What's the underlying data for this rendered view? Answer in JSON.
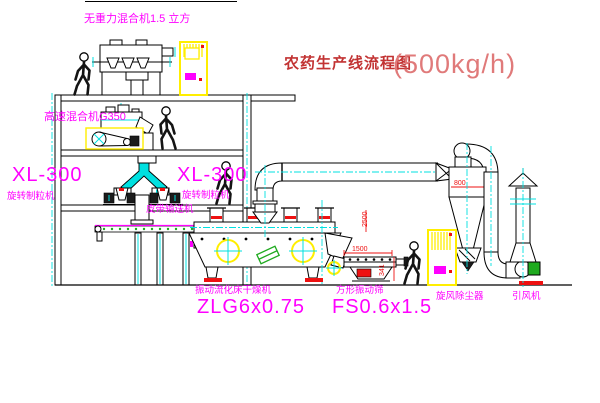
{
  "diagram": {
    "title": "农药生产线流程图",
    "capacity": "(500kg/h)"
  },
  "labels": {
    "gravity_mixer": "无重力混合机1.5 立方",
    "high_speed_mixer": "高速混合机G350",
    "granulator_left_model": "XL-300",
    "granulator_left_name": "旋转制粒机",
    "granulator_right_model": "XL-300",
    "granulator_right_name": "旋转制粒机",
    "belt_conveyor": "皮带输送机",
    "fluid_bed_name": "振动流化床干燥机",
    "fluid_bed_model": "ZLG6x0.75",
    "sieve_name": "方形振动筛",
    "sieve_model": "FS0.6x1.5",
    "cyclone": "旋风除尘器",
    "fan": "引风机"
  },
  "dimensions": {
    "cyclone_width": "800",
    "bed_outlet_height": "2500",
    "sieve_length": "1500",
    "sieve_height": "341"
  },
  "colors": {
    "label": "#ff00ff",
    "centerline": "#00e0e0",
    "dimension": "#ee1111",
    "cabinet": "#ffee00",
    "title_text": "#c23333",
    "title_capacity": "#e07a7a",
    "motor_green": "#1faa1f"
  }
}
